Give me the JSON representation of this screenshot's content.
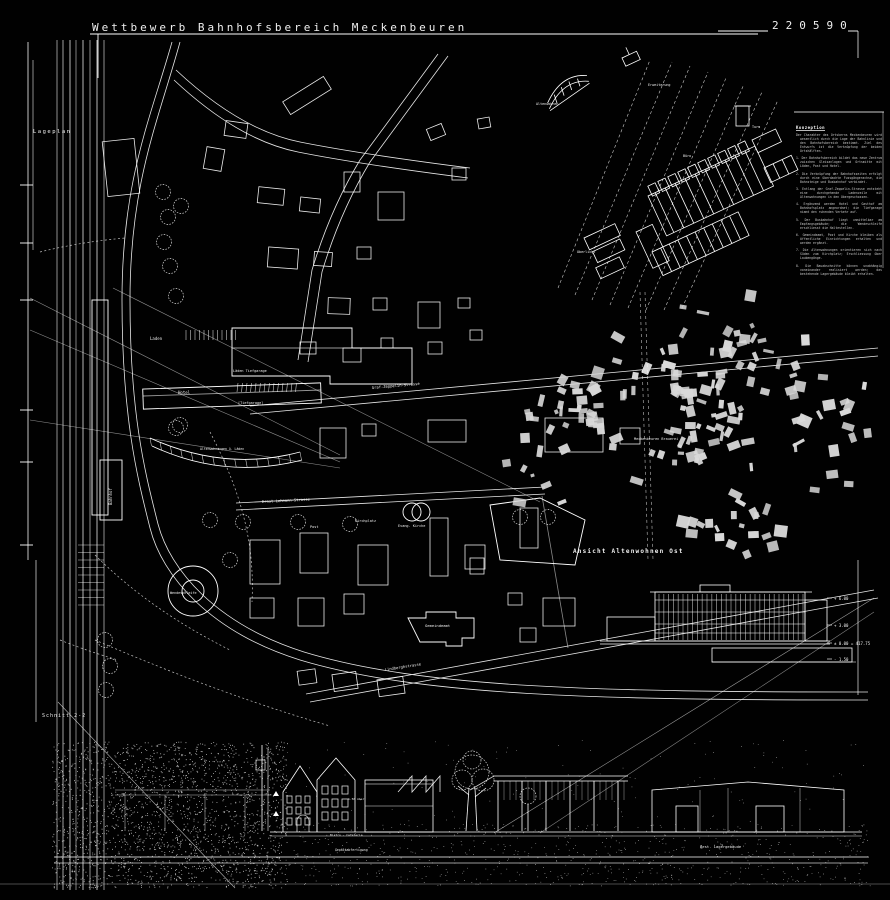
{
  "colors": {
    "background": "#010101",
    "line": "#ffffff",
    "figure_fill": "#d9d9d9"
  },
  "header": {
    "title": "Wettbewerb Bahnhofsbereich Meckenbeuren",
    "entry_number": "220590"
  },
  "labels": {
    "lageplan": "Lageplan",
    "schnitt": "Schnitt 2-2",
    "ansicht": "Ansicht Altenwohnen  Ost",
    "bahnhof": "Bahnhof",
    "hotel": "Hotel",
    "laden": "Laden",
    "laeden_tiefgarage": "Läden  Tiefgarage",
    "tiefgarage": "[Tiefgarage]",
    "altenwohnungen": "Altenwohnungen ü. Läden",
    "graf_zeppelin": "Graf-Zeppelin-Strasse",
    "ernst_lehmann": "Ernst-Lehmann-Strasse",
    "lindbergh": "Lindberghstrasse",
    "post": "Post",
    "kirchplatz": "Kirchplatz",
    "evang_kirche": "Evang. Kirche",
    "brauerei": "Meckenbeuren Brauerei",
    "gemeindeamt": "Gemeindeamt",
    "wendeschleife": "Wendeschleife",
    "best_lager": "Best. Lagergebäude",
    "gepaeck": "Gepäckabfertigung",
    "bistro": "Bistro - Cafeteria",
    "hoehe": "1.50 über",
    "axon": {
      "altenwohnen": "Altenwohnen",
      "erweiterung": "Erweiterung",
      "turm": "Turm",
      "oberlicht": "Oberlicht",
      "buero": "Büro"
    },
    "levels": [
      "+ 6.00",
      "+ 3.00",
      "± 0.00 = 417.75",
      "- 1.50"
    ]
  },
  "notes": {
    "title": "Konzeption",
    "paragraphs": [
      "Der Charakter des Ortskerns Meckenbeuren wird wesentlich durch die Lage der Bahnlinie und den Bahnhofsbereich bestimmt. Ziel des Entwurfs ist die Verknüpfung der beiden Ortshälften.",
      "1. Der Bahnhofsbereich bildet das neue Zentrum zwischen Gleisanlagen und Ortsmitte mit Läden, Post und Hotel.",
      "2. Die Verknüpfung der Bahnhofsseiten erfolgt durch eine überdachte Fussgängerachse, die Bahnsteige und Busbahnhof verbindet.",
      "3. Entlang der Graf-Zeppelin-Strasse entsteht eine durchgehende Ladenzeile mit Altenwohnungen in den Obergeschossen.",
      "4. Ergänzend werden Hotel und Gasthof am Bahnhofsplatz angeordnet; die Tiefgarage nimmt den ruhenden Verkehr auf.",
      "5. Der Busbahnhof liegt unmittelbar am Empfangsgebäude; die Wendeschleife erschliesst die Haltestellen.",
      "6. Gemeindeamt, Post und Kirche bleiben als öffentliche Einrichtungen erhalten und werden ergänzt.",
      "7. Die Altenwohnungen orientieren sich nach Süden zum Kirchplatz; Erschliessung über Laubengänge.",
      "8. Die Bauabschnitte können unabhängig voneinander realisiert werden; das bestehende Lagergebäude bleibt erhalten."
    ]
  }
}
